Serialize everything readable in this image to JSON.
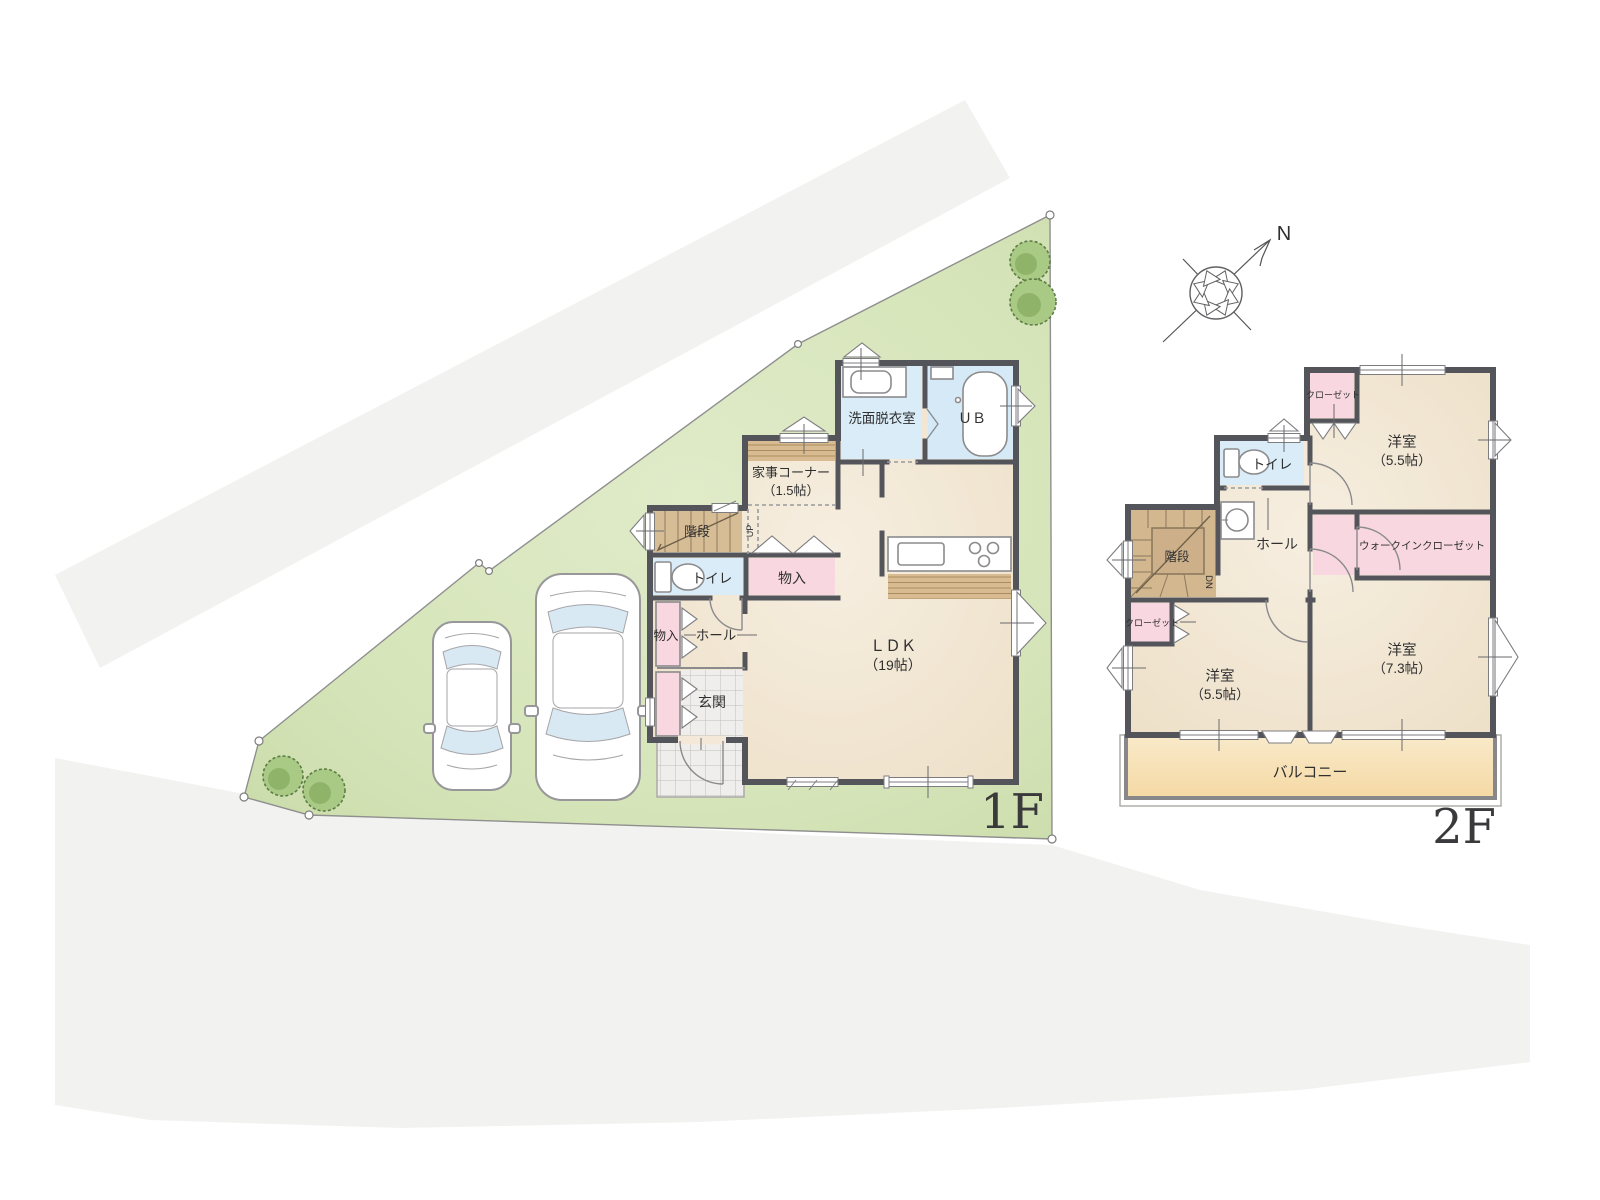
{
  "title": "house floor plan 1F 2F with site plan",
  "palette": {
    "wall": "#54555a",
    "floor_beige": "#f4e9d8",
    "wet_blue": "#d9ecf7",
    "closet_pink": "#f8d7e0",
    "wood": "#d8bb90",
    "balcony_orange": "#f8e2b8",
    "lawn_green": "#d8e7bf",
    "road_gray": "#f2f2f0",
    "tile_gray": "#efeeec"
  },
  "compass": {
    "north": "N"
  },
  "floor1": {
    "name": "1F",
    "rooms": {
      "washroom": "洗面脱衣室",
      "bath": "ＵＢ",
      "utility": "家事コーナー",
      "utility_size": "（1.5帖）",
      "stairs": "階段",
      "up": "UP",
      "toilet": "トイレ",
      "storage": "物入",
      "storage_hall": "物入",
      "hall": "ホール",
      "entrance": "玄関",
      "ldk": "ＬＤＫ",
      "ldk_size": "（19帖）"
    }
  },
  "floor2": {
    "name": "2F",
    "rooms": {
      "closet_a": "クローゼット",
      "bedroom1": "洋室",
      "bedroom1_size": "（5.5帖）",
      "toilet": "トイレ",
      "hall": "ホール",
      "stairs": "階段",
      "down": "DN",
      "wic": "ウォークインクローゼット",
      "closet_b": "クローゼット",
      "bedroom2": "洋室",
      "bedroom2_size": "（5.5帖）",
      "bedroom3": "洋室",
      "bedroom3_size": "（7.3帖）",
      "balcony": "バルコニー"
    }
  }
}
